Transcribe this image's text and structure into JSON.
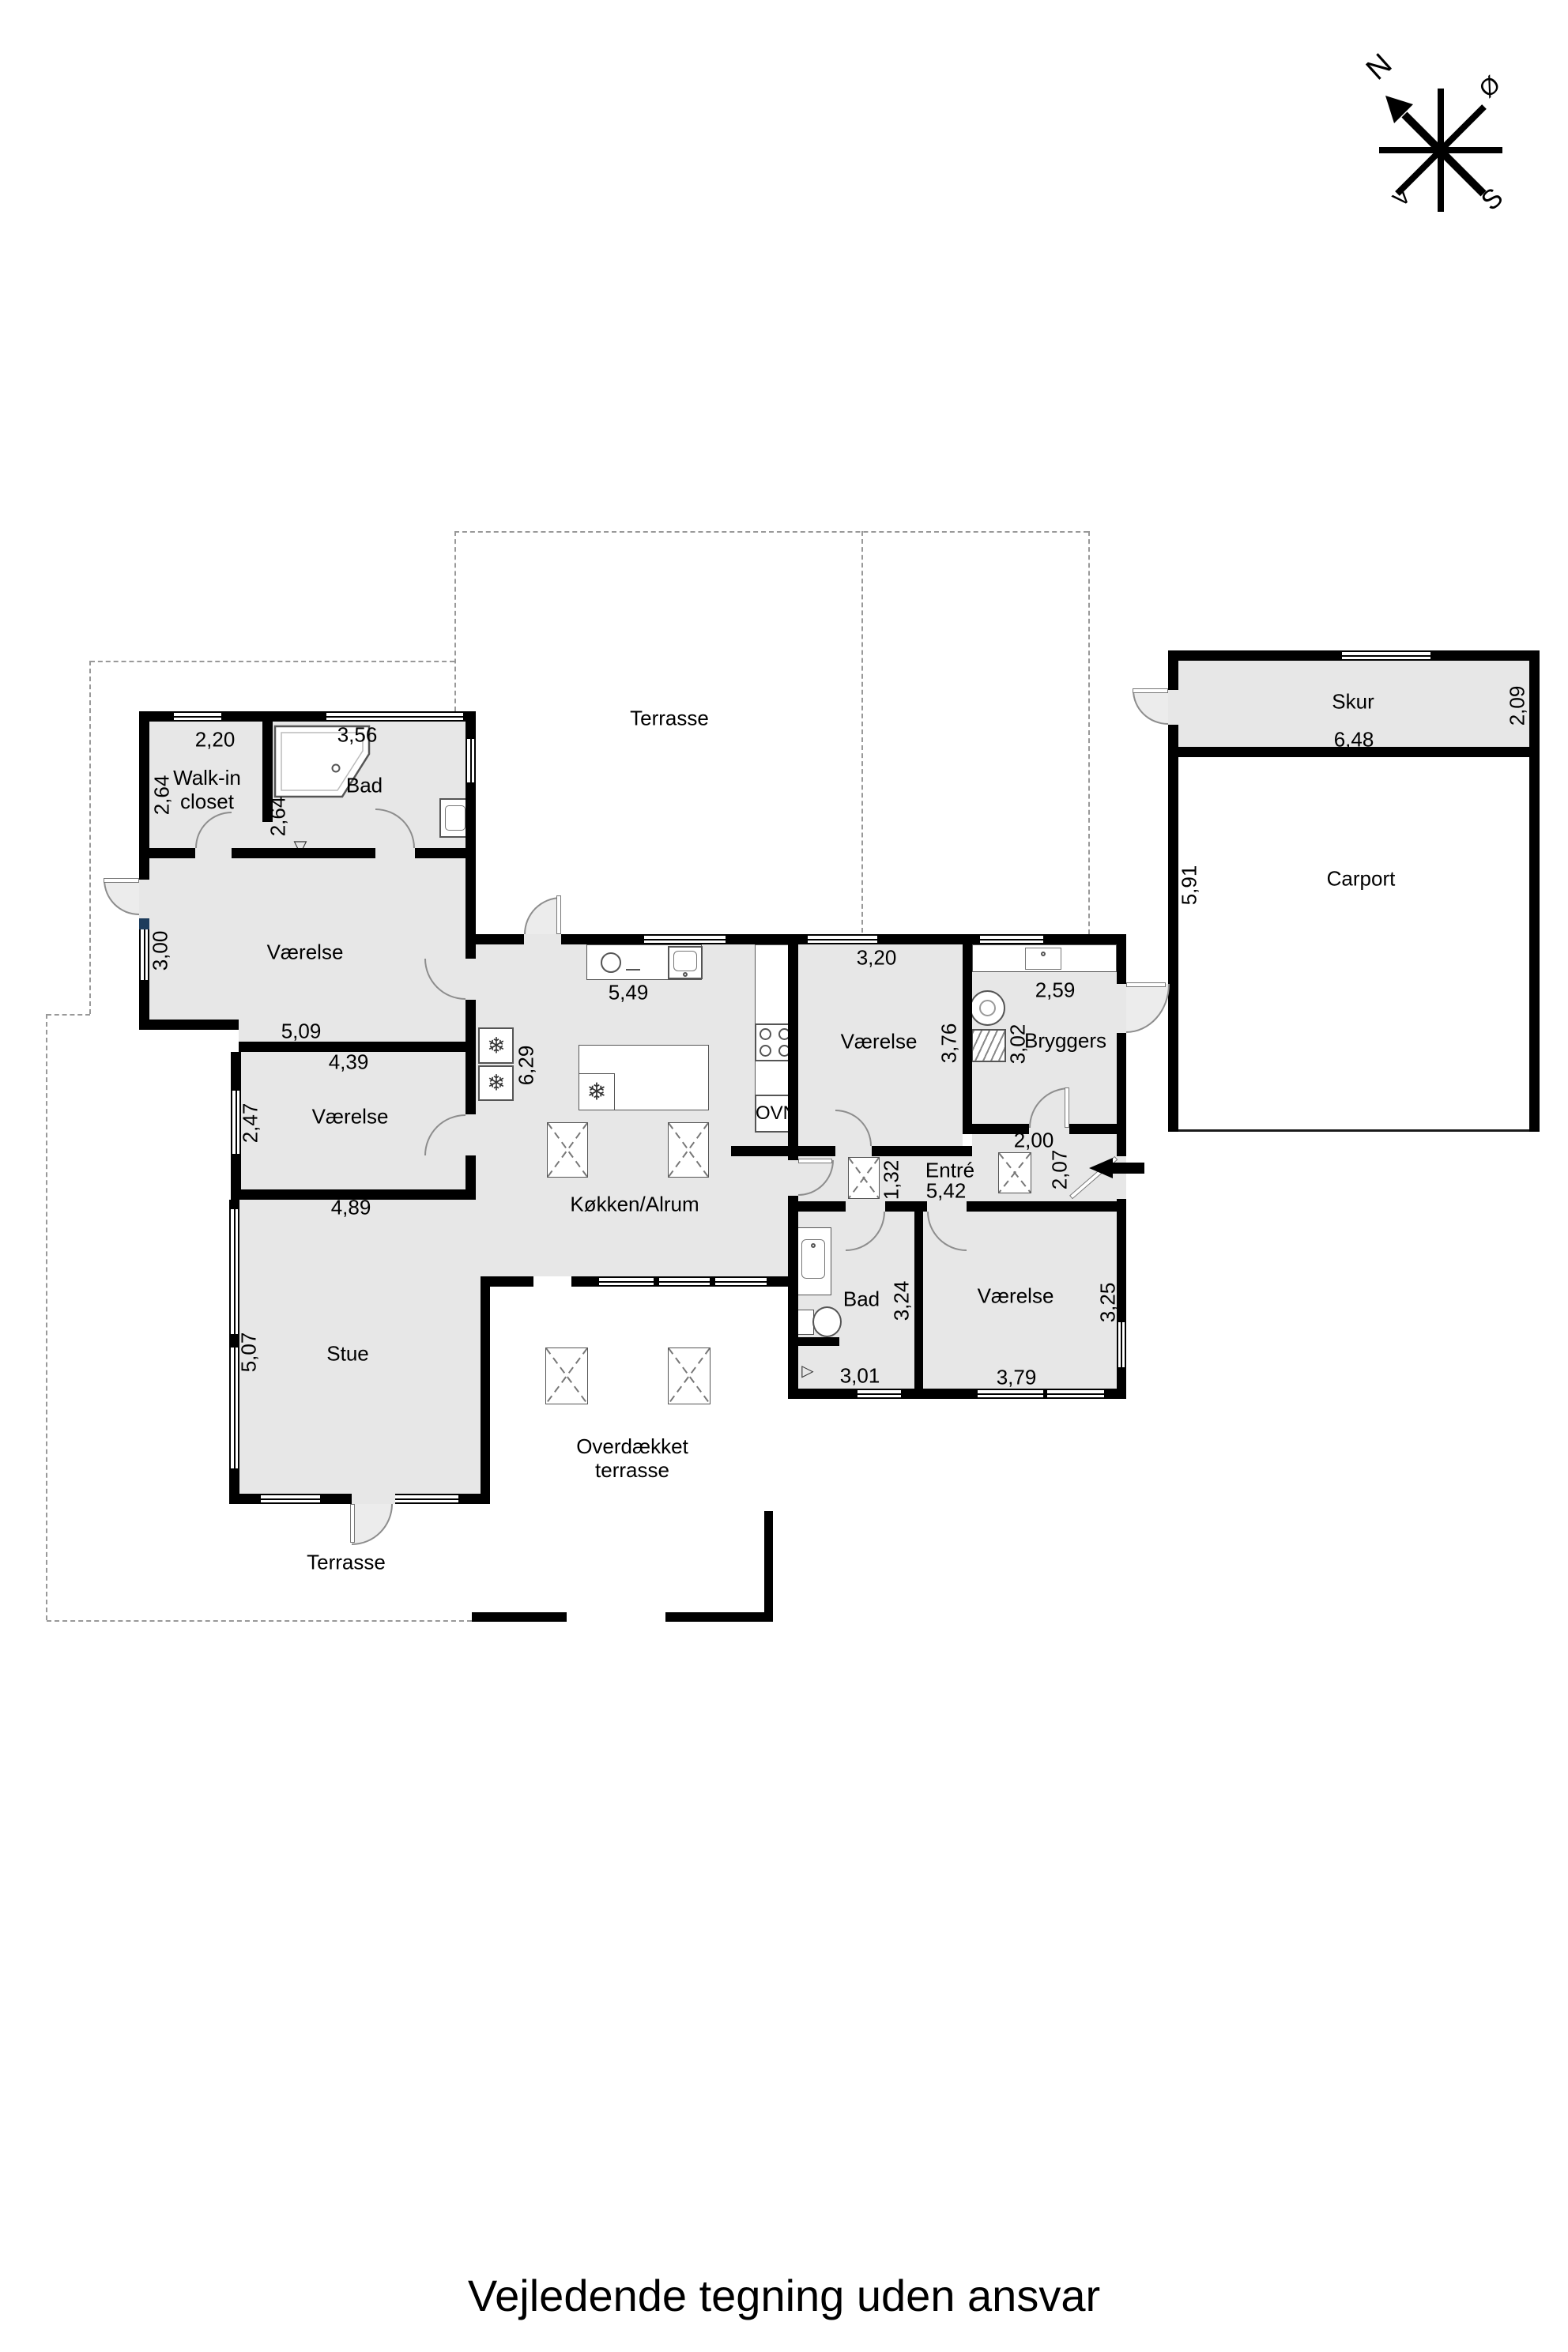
{
  "footer": "Vejledende tegning uden ansvar",
  "compass": {
    "n": "N",
    "e": "Ø",
    "s": "S",
    "v": "V"
  },
  "colors": {
    "room_fill": "#e7e7e7",
    "wall": "#000000",
    "dashed_line": "#999999",
    "navy_marker": "#1d3c5c"
  },
  "icons": {
    "freezer": "❄",
    "drain": "▽",
    "drain_side": "▷"
  },
  "rooms": {
    "walk_in": {
      "name": "Walk-in closet",
      "w": "2,20",
      "d": "2,64"
    },
    "bad_n": {
      "name": "Bad",
      "w": "3,56",
      "d": "2,64"
    },
    "vaerelse_nw": {
      "name": "Værelse",
      "w": "5,09",
      "d": "3,00"
    },
    "vaerelse_w": {
      "name": "Værelse",
      "w_top": "4,39",
      "w_bot": "4,89",
      "d": "2,47"
    },
    "stue": {
      "name": "Stue",
      "d": "5,07"
    },
    "koekken": {
      "name": "Køkken/Alrum",
      "w": "5,49",
      "d": "6,29",
      "oven": "OVN"
    },
    "terrasse_n": {
      "name": "Terrasse"
    },
    "terrasse_s": {
      "name": "Terrasse"
    },
    "overdaekket": {
      "name": "Overdækket terrasse"
    },
    "vaerelse_c": {
      "name": "Værelse",
      "w": "3,20",
      "d": "3,76"
    },
    "bryggers": {
      "name": "Bryggers",
      "w": "2,59",
      "d": "3,02"
    },
    "entre": {
      "name": "Entré",
      "w": "5,42",
      "d": "1,32",
      "dim_a": "2,00",
      "dim_b": "2,07"
    },
    "bad_s": {
      "name": "Bad",
      "w": "3,01",
      "d": "3,24"
    },
    "vaerelse_se": {
      "name": "Værelse",
      "w": "3,79",
      "d": "3,25"
    },
    "skur": {
      "name": "Skur",
      "w": "6,48",
      "d": "2,09"
    },
    "carport": {
      "name": "Carport",
      "d": "5,91"
    }
  }
}
